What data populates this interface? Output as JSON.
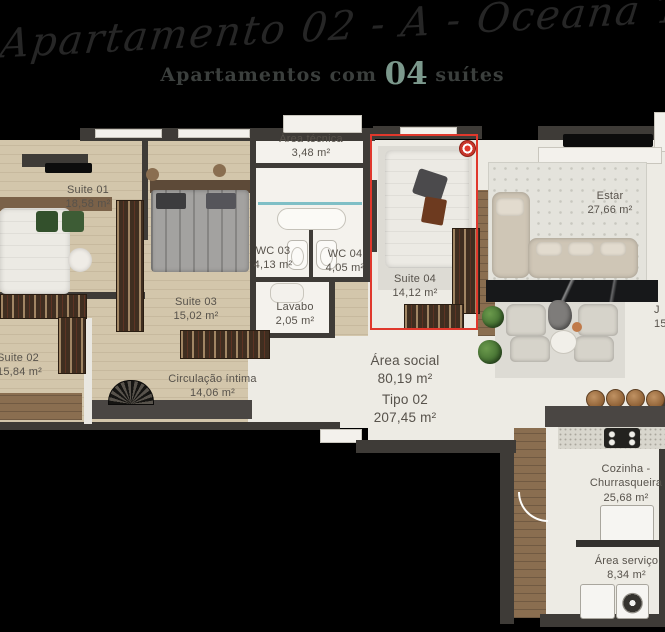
{
  "header": {
    "script_title": "Apartamento 02 - A - Oceana Tower",
    "subtitle": {
      "prefix": "Apartamentos com",
      "number": "04",
      "suffix": "suítes"
    }
  },
  "rooms": {
    "suite01": {
      "name": "Suite 01",
      "area": "18,58 m²"
    },
    "area_tecnica": {
      "name": "Área técnica",
      "area": "3,48 m²"
    },
    "wc03": {
      "name": "WC 03",
      "area": "4,13 m²"
    },
    "wc04": {
      "name": "WC 04",
      "area": "4,05 m²"
    },
    "suite04": {
      "name": "Suite 04",
      "area": "14,12 m²"
    },
    "estar": {
      "name": "Estar",
      "area": "27,66 m²"
    },
    "suite03": {
      "name": "Suite 03",
      "area": "15,02 m²"
    },
    "lavabo": {
      "name": "Lavabo",
      "area": "2,05 m²"
    },
    "suite02": {
      "name": "Suite 02",
      "area": "15,84 m²"
    },
    "circulacao": {
      "name": "Circulação íntima",
      "area": "14,06 m²"
    },
    "area_social": {
      "name": "Área social",
      "area": "80,19 m²"
    },
    "tipo": {
      "name": "Tipo 02",
      "area": "207,45 m²"
    },
    "cozinha": {
      "name": "Cozinha - Churrasqueira",
      "area": "25,68 m²"
    },
    "area_servico": {
      "name": "Área serviço",
      "area": "8,34 m²"
    }
  },
  "partial_label_right": {
    "line1": "J",
    "line2": "15"
  },
  "highlight": {
    "room": "Suite 04",
    "style": "red outline"
  },
  "colors": {
    "background": "#000000",
    "highlight_red": "#e0382c",
    "accent_green": "#7b988c",
    "wall_dark": "#3e3b37",
    "floor_wood": "#d3c6ab",
    "floor_light": "#edebe4",
    "floor_hall_wood": "#8a6e50",
    "label_text": "#57524b",
    "glass_teal": "#7fbfc6"
  }
}
